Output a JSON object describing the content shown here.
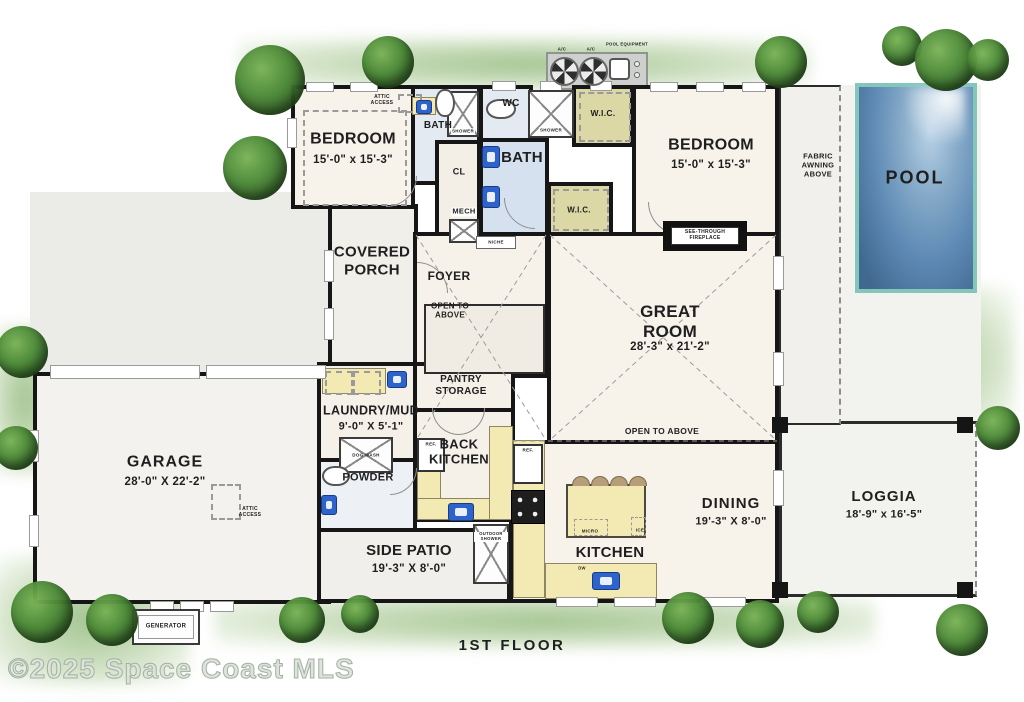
{
  "title": "1ST FLOOR",
  "watermark": "©2025 Space Coast MLS",
  "palette": {
    "wall": "#161616",
    "counter_yellow": "#f3e9b2",
    "wic_olive": "#dbd8a6",
    "bath_floor_blue": "#d6e1ef",
    "pool_water_blue": "#5d89b4",
    "pool_border_teal": "#83c7ba",
    "tree_green": "#3f7d32",
    "equipment_pad_gray": "#cdd0cd"
  },
  "rooms": {
    "bedroom_left": {
      "name": "BEDROOM",
      "dims": "15'-0\" x 15'-3\""
    },
    "bath_left": {
      "name": "BATH"
    },
    "wc": {
      "name": "WC"
    },
    "bath_main": {
      "name": "BATH"
    },
    "wic_top": {
      "name": "W.I.C."
    },
    "wic_lower": {
      "name": "W.I.C."
    },
    "closet": {
      "name": "CL"
    },
    "mech": {
      "name": "MECH"
    },
    "bedroom_right": {
      "name": "BEDROOM",
      "dims": "15'-0\" x 15'-3\""
    },
    "pool": {
      "name": "POOL"
    },
    "covered_porch": {
      "name": "COVERED PORCH"
    },
    "foyer": {
      "name": "FOYER"
    },
    "great_room": {
      "name": "GREAT ROOM",
      "dims": "28'-3\" x 21'-2\""
    },
    "pantry": {
      "name": "PANTRY STORAGE"
    },
    "laundry_mud": {
      "name": "LAUNDRY/MUD",
      "dims": "9'-0\" X 5'-1\""
    },
    "powder": {
      "name": "POWDER"
    },
    "back_kitchen": {
      "name": "BACK KITCHEN"
    },
    "garage": {
      "name": "GARAGE",
      "dims": "28'-0\" X 22'-2\""
    },
    "side_patio": {
      "name": "SIDE PATIO",
      "dims": "19'-3\" X 8'-0\""
    },
    "kitchen": {
      "name": "KITCHEN"
    },
    "dining": {
      "name": "DINING",
      "dims": "19'-3\" X 8'-0\""
    },
    "loggia": {
      "name": "LOGGIA",
      "dims": "18'-9\" x 16'-5\""
    }
  },
  "labels": {
    "ac": "A/C",
    "pool_equipment": "POOL EQUIPMENT",
    "fabric_awning": "FABRIC AWNING ABOVE",
    "attic_access": "ATTIC ACCESS",
    "shower": "SHOWER",
    "niche": "NICHE",
    "see_through_fireplace": "SEE-THROUGH FIREPLACE",
    "open_to_above": "OPEN TO ABOVE",
    "dog_wash": "DOG WASH",
    "ref": "REF.",
    "micro": "MICRO",
    "ice": "ICE",
    "dw": "DW",
    "outdoor_shower": "OUTDOOR SHOWER",
    "generator": "GENERATOR"
  }
}
